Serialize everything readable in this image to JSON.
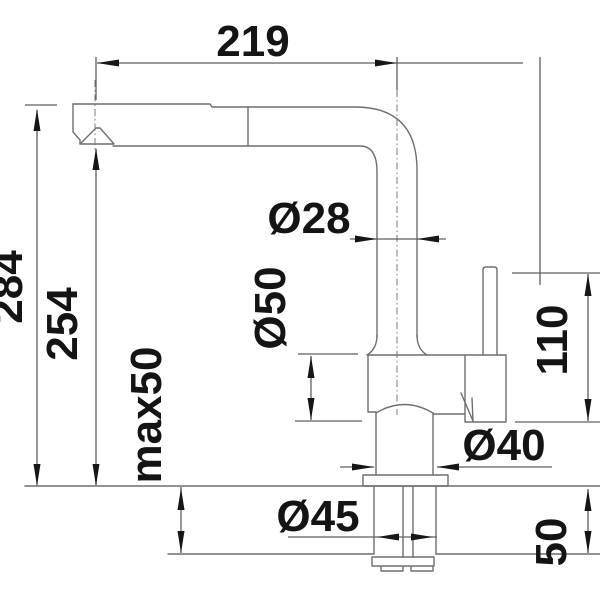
{
  "drawing": {
    "title": "faucet-dimension-drawing",
    "dimensions": {
      "spout_reach": {
        "label": "219",
        "unit": "mm",
        "orientation": "horizontal"
      },
      "overall_height": {
        "label": "284",
        "unit": "mm",
        "orientation": "vertical"
      },
      "spout_outlet_height": {
        "label": "254",
        "unit": "mm",
        "orientation": "vertical"
      },
      "max_counter_thickness": {
        "label": "max50",
        "unit": "mm",
        "orientation": "vertical"
      },
      "spout_pipe_diameter": {
        "label": "Ø28",
        "unit": "mm",
        "orientation": "horizontal"
      },
      "body_diameter": {
        "label": "Ø50",
        "unit": "mm",
        "orientation": "vertical"
      },
      "body_height": {
        "label": "110",
        "unit": "mm",
        "orientation": "vertical"
      },
      "base_diameter": {
        "label": "Ø40",
        "unit": "mm",
        "orientation": "horizontal"
      },
      "shank_diameter": {
        "label": "Ø45",
        "unit": "mm",
        "orientation": "horizontal"
      },
      "under_counter_depth": {
        "label": "50",
        "unit": "mm",
        "orientation": "vertical"
      }
    },
    "colors": {
      "line": "#6f6f6f",
      "dimension_line": "#5f5f5f",
      "label": "#141414",
      "background": "#ffffff"
    }
  }
}
